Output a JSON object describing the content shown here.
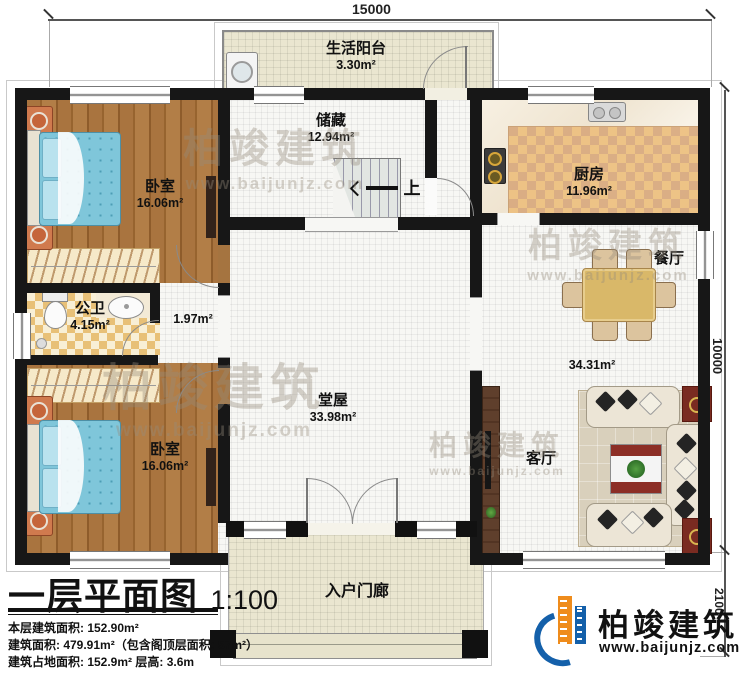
{
  "title_block": {
    "title": "一层平面图",
    "scale": "1:100",
    "info_lines": [
      "本层建筑面积: 152.90m²",
      "建筑面积: 479.91m²（包含阁顶层面积: 57m²）",
      "建筑占地面积: 152.9m²  层高: 3.6m"
    ]
  },
  "dimensions": {
    "top": "15000",
    "right": "10000",
    "porch": "2100"
  },
  "rooms": {
    "balcony": {
      "name": "生活阳台",
      "area": "3.30m²"
    },
    "storage": {
      "name": "储藏",
      "area": "12.94m²"
    },
    "kitchen": {
      "name": "厨房",
      "area": "11.96m²"
    },
    "dining": {
      "name": "餐厅"
    },
    "bedroom1": {
      "name": "卧室",
      "area": "16.06m²"
    },
    "bathroom": {
      "name": "公卫",
      "area": "4.15m²"
    },
    "vestibule": {
      "area": "1.97m²"
    },
    "bedroom2": {
      "name": "卧室",
      "area": "16.06m²"
    },
    "hall": {
      "name": "堂屋",
      "area": "33.98m²"
    },
    "living": {
      "name": "客厅"
    },
    "dining_living_area": "34.31m²",
    "porch": {
      "name": "入户门廊"
    }
  },
  "stairs": {
    "up_label": "上"
  },
  "branding": {
    "company": "柏竣建筑",
    "website": "www.baijunjz.com"
  },
  "watermark": {
    "company": "柏竣建筑",
    "website": "www.baijunjz.com"
  }
}
